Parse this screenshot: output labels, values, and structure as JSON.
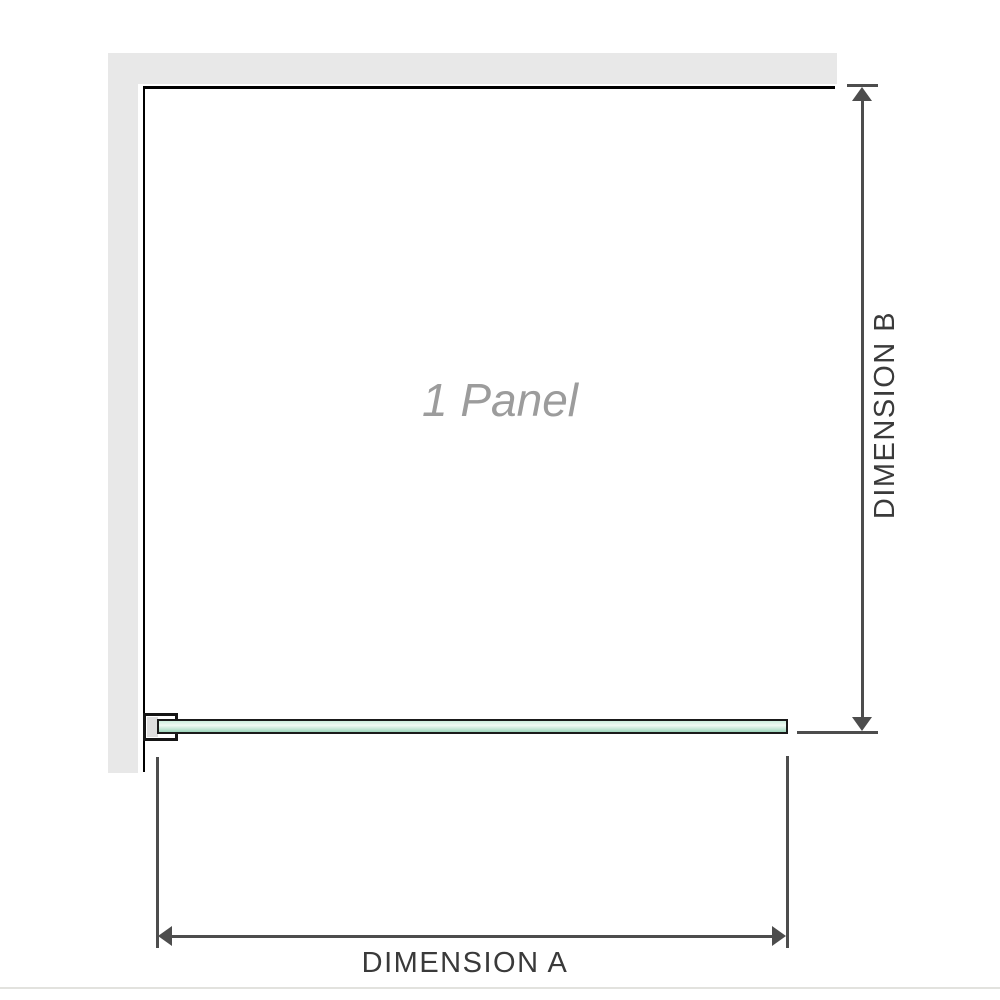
{
  "diagram": {
    "title": "shower-panel-dimension-diagram",
    "panel_label": "1 Panel",
    "dimension_a": {
      "label": "DIMENSION A",
      "orientation": "horizontal",
      "measures": "glass panel width"
    },
    "dimension_b": {
      "label": "DIMENSION B",
      "orientation": "vertical",
      "measures": "glass panel height"
    },
    "parts": {
      "wall": "L-shaped wall (top and left)",
      "glass": "green glass panel strip (plan view)",
      "bracket": "wall mounting bracket at left end of glass"
    },
    "colors": {
      "wall": "#e8e8e8",
      "panel_border": "#000000",
      "glass_green": "#9ed6bc",
      "glass_mid": "#cdeedd",
      "glass_highlight": "#f0faf4",
      "dimension_line": "#4d4d4d",
      "label_gray": "#9c9c9c",
      "text_dark": "#3a3a3a",
      "bottom_rule": "#e2e2de"
    }
  }
}
